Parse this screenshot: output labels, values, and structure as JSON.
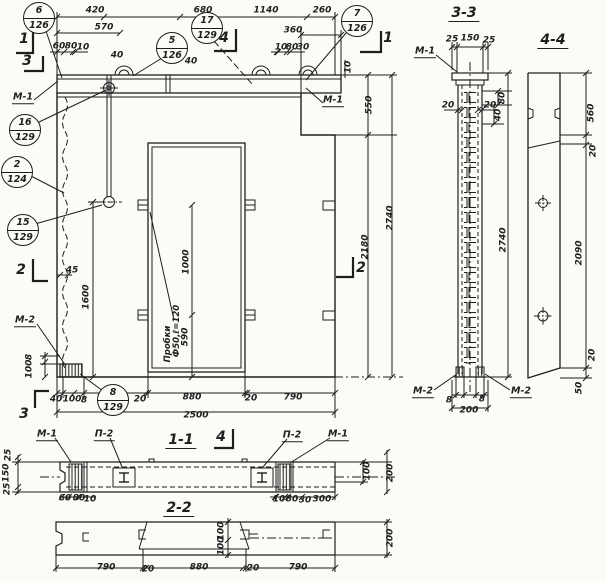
{
  "drawing": {
    "kind": "precast concrete wall panel working drawing",
    "language": "ru",
    "ink_color": "#1e1e1e",
    "paper_color": "#fbfbf7"
  },
  "section_titles": [
    {
      "text": "3-3",
      "x": 464,
      "y": 14
    },
    {
      "text": "4-4",
      "x": 553,
      "y": 41
    },
    {
      "text": "1-1",
      "x": 181,
      "y": 441
    },
    {
      "text": "2-2",
      "x": 179,
      "y": 509
    }
  ],
  "section_markers": [
    {
      "text": "1",
      "x": 24,
      "y": 39
    },
    {
      "text": "3",
      "x": 27,
      "y": 61
    },
    {
      "text": "1",
      "x": 388,
      "y": 38
    },
    {
      "text": "4",
      "x": 224,
      "y": 38
    },
    {
      "text": "2",
      "x": 21,
      "y": 270
    },
    {
      "text": "2",
      "x": 361,
      "y": 268
    },
    {
      "text": "3",
      "x": 24,
      "y": 414
    },
    {
      "text": "4",
      "x": 221,
      "y": 437
    }
  ],
  "callouts": [
    {
      "top": "6",
      "bottom": "126",
      "x": 39,
      "y": 18
    },
    {
      "top": "5",
      "bottom": "126",
      "x": 172,
      "y": 48
    },
    {
      "top": "17",
      "bottom": "129",
      "x": 207,
      "y": 28
    },
    {
      "top": "7",
      "bottom": "126",
      "x": 357,
      "y": 21
    },
    {
      "top": "16",
      "bottom": "129",
      "x": 25,
      "y": 130
    },
    {
      "top": "2",
      "bottom": "124",
      "x": 17,
      "y": 172
    },
    {
      "top": "15",
      "bottom": "129",
      "x": 23,
      "y": 230
    },
    {
      "top": "8",
      "bottom": "129",
      "x": 113,
      "y": 400
    }
  ],
  "part_labels": [
    {
      "text": "М-1",
      "x": 23,
      "y": 98
    },
    {
      "text": "М-1",
      "x": 333,
      "y": 101
    },
    {
      "text": "М-2",
      "x": 25,
      "y": 321
    },
    {
      "text": "М-1",
      "x": 425,
      "y": 52
    },
    {
      "text": "М-2",
      "x": 423,
      "y": 392
    },
    {
      "text": "М-2",
      "x": 521,
      "y": 392
    },
    {
      "text": "М-1",
      "x": 47,
      "y": 435
    },
    {
      "text": "П-2",
      "x": 104,
      "y": 435
    },
    {
      "text": "П-2",
      "x": 292,
      "y": 436
    },
    {
      "text": "М-1",
      "x": 338,
      "y": 435
    }
  ],
  "notes": [
    {
      "text": "Пробки",
      "x": 168,
      "y": 344,
      "rot": true
    },
    {
      "text": "Ф50,ℓ=120",
      "x": 177,
      "y": 331,
      "rot": true
    }
  ],
  "dimensions": [
    {
      "text": "420",
      "x": 95,
      "y": 11
    },
    {
      "text": "680",
      "x": 203,
      "y": 11
    },
    {
      "text": "1140",
      "x": 266,
      "y": 11
    },
    {
      "text": "260",
      "x": 322,
      "y": 11
    },
    {
      "text": "570",
      "x": 104,
      "y": 28
    },
    {
      "text": "360",
      "x": 293,
      "y": 31
    },
    {
      "text": "60",
      "x": 59,
      "y": 47
    },
    {
      "text": "80",
      "x": 71,
      "y": 47
    },
    {
      "text": "10",
      "x": 83,
      "y": 48
    },
    {
      "text": "40",
      "x": 117,
      "y": 56
    },
    {
      "text": "40",
      "x": 191,
      "y": 62
    },
    {
      "text": "10",
      "x": 281,
      "y": 48
    },
    {
      "text": "80",
      "x": 292,
      "y": 48
    },
    {
      "text": "30",
      "x": 303,
      "y": 48
    },
    {
      "text": "10",
      "x": 349,
      "y": 67,
      "rot": true
    },
    {
      "text": "550",
      "x": 370,
      "y": 105,
      "rot": true
    },
    {
      "text": "2180",
      "x": 366,
      "y": 247,
      "rot": true
    },
    {
      "text": "2740",
      "x": 391,
      "y": 218,
      "rot": true
    },
    {
      "text": "45",
      "x": 72,
      "y": 271
    },
    {
      "text": "1600",
      "x": 87,
      "y": 297,
      "rot": true
    },
    {
      "text": "8",
      "x": 30,
      "y": 357,
      "rot": true
    },
    {
      "text": "100",
      "x": 30,
      "y": 369,
      "rot": true
    },
    {
      "text": "1000",
      "x": 187,
      "y": 262,
      "rot": true
    },
    {
      "text": "590",
      "x": 186,
      "y": 337,
      "rot": true
    },
    {
      "text": "40",
      "x": 56,
      "y": 400
    },
    {
      "text": "100",
      "x": 72,
      "y": 400
    },
    {
      "text": "8",
      "x": 84,
      "y": 401
    },
    {
      "text": "20",
      "x": 140,
      "y": 400
    },
    {
      "text": "880",
      "x": 192,
      "y": 398
    },
    {
      "text": "20",
      "x": 251,
      "y": 399
    },
    {
      "text": "790",
      "x": 293,
      "y": 398
    },
    {
      "text": "2500",
      "x": 196,
      "y": 416
    },
    {
      "text": "25",
      "x": 452,
      "y": 40
    },
    {
      "text": "150",
      "x": 470,
      "y": 39
    },
    {
      "text": "25",
      "x": 489,
      "y": 41
    },
    {
      "text": "80",
      "x": 503,
      "y": 98,
      "rot": true
    },
    {
      "text": "40",
      "x": 499,
      "y": 115,
      "rot": true
    },
    {
      "text": "20",
      "x": 448,
      "y": 106
    },
    {
      "text": "20",
      "x": 490,
      "y": 106
    },
    {
      "text": "2740",
      "x": 504,
      "y": 240,
      "rot": true
    },
    {
      "text": "8",
      "x": 449,
      "y": 401
    },
    {
      "text": "8",
      "x": 482,
      "y": 400
    },
    {
      "text": "200",
      "x": 469,
      "y": 411
    },
    {
      "text": "560",
      "x": 592,
      "y": 113,
      "rot": true
    },
    {
      "text": "20",
      "x": 594,
      "y": 151,
      "rot": true
    },
    {
      "text": "2090",
      "x": 580,
      "y": 253,
      "rot": true
    },
    {
      "text": "20",
      "x": 593,
      "y": 355,
      "rot": true
    },
    {
      "text": "50",
      "x": 580,
      "y": 388,
      "rot": true
    },
    {
      "text": "25",
      "x": 9,
      "y": 455,
      "rot": true
    },
    {
      "text": "150",
      "x": 7,
      "y": 473,
      "rot": true
    },
    {
      "text": "25",
      "x": 8,
      "y": 489,
      "rot": true
    },
    {
      "text": "60",
      "x": 65,
      "y": 499
    },
    {
      "text": "80",
      "x": 79,
      "y": 499
    },
    {
      "text": "10",
      "x": 90,
      "y": 500
    },
    {
      "text": "10",
      "x": 279,
      "y": 500
    },
    {
      "text": "80",
      "x": 292,
      "y": 500
    },
    {
      "text": "30",
      "x": 305,
      "y": 501
    },
    {
      "text": "300",
      "x": 322,
      "y": 500
    },
    {
      "text": "100",
      "x": 368,
      "y": 471,
      "rot": true
    },
    {
      "text": "200",
      "x": 391,
      "y": 473,
      "rot": true
    },
    {
      "text": "100",
      "x": 222,
      "y": 531,
      "rot": true
    },
    {
      "text": "100",
      "x": 222,
      "y": 546,
      "rot": true
    },
    {
      "text": "790",
      "x": 106,
      "y": 568
    },
    {
      "text": "20",
      "x": 148,
      "y": 570
    },
    {
      "text": "880",
      "x": 199,
      "y": 568
    },
    {
      "text": "20",
      "x": 253,
      "y": 569
    },
    {
      "text": "790",
      "x": 298,
      "y": 568
    },
    {
      "text": "200",
      "x": 391,
      "y": 538,
      "rot": true
    }
  ]
}
